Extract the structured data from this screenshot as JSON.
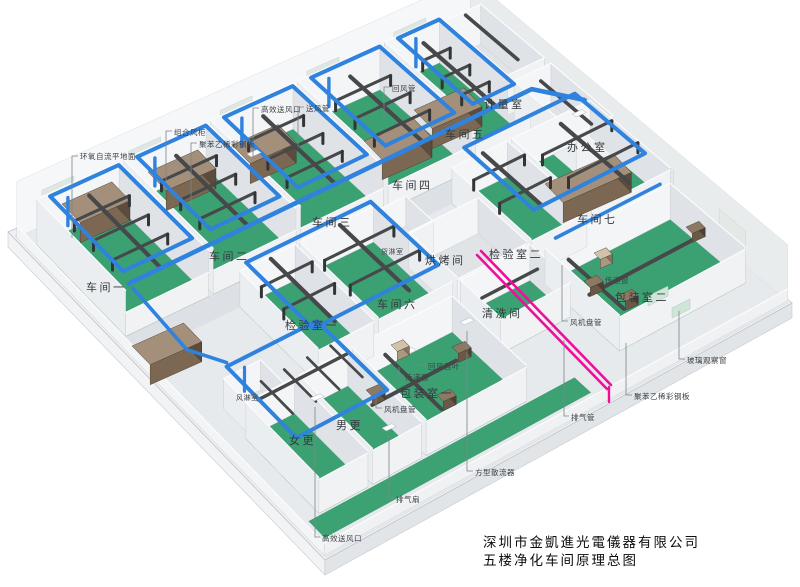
{
  "title_block": {
    "line1": "深圳市金凱進光電儀器有限公司",
    "line2": "五楼净化车间原理总图"
  },
  "rooms": [
    {
      "id": "workshop-1",
      "label": "车间一"
    },
    {
      "id": "workshop-2",
      "label": "车间二"
    },
    {
      "id": "workshop-3",
      "label": "车间三"
    },
    {
      "id": "workshop-4",
      "label": "车间四"
    },
    {
      "id": "workshop-5",
      "label": "车间五"
    },
    {
      "id": "metering-room",
      "label": "计量室"
    },
    {
      "id": "office",
      "label": "办公室"
    },
    {
      "id": "workshop-7",
      "label": "车间七"
    },
    {
      "id": "inspection-room-2",
      "label": "检验室二"
    },
    {
      "id": "baking-room",
      "label": "烘烤间"
    },
    {
      "id": "cargo-shower-room",
      "label": "货淋室"
    },
    {
      "id": "cleaning-room",
      "label": "清洗间"
    },
    {
      "id": "packing-room-2",
      "label": "包装室二"
    },
    {
      "id": "inspection-room-1",
      "label": "检验室一"
    },
    {
      "id": "workshop-6",
      "label": "车间六"
    },
    {
      "id": "packing-room-1",
      "label": "包装室一"
    },
    {
      "id": "women-changing-room",
      "label": "女更"
    },
    {
      "id": "men-changing-room",
      "label": "男更"
    },
    {
      "id": "air-shower-room",
      "label": "风淋室"
    }
  ],
  "callouts": [
    {
      "id": "epoxy-self-leveling-floor",
      "label": "环氧自流平地面"
    },
    {
      "id": "combined-air-handling-unit",
      "label": "组合风柜"
    },
    {
      "id": "polystyrene-steel-panel",
      "label": "聚苯乙稀彩钢板"
    },
    {
      "id": "hepa-supply-outlet",
      "label": "高效送风口"
    },
    {
      "id": "supply-air-duct",
      "label": "送风管"
    },
    {
      "id": "return-air-duct",
      "label": "回风管"
    },
    {
      "id": "return-air-louver",
      "label": "回风百叶"
    },
    {
      "id": "pass-through-window-1",
      "label": "传递窗"
    },
    {
      "id": "fan-coil-unit-1",
      "label": "风机盘管"
    },
    {
      "id": "exhaust-fan",
      "label": "排气扇"
    },
    {
      "id": "hepa-supply-outlet-2",
      "label": "高效送风口"
    },
    {
      "id": "square-diffuser",
      "label": "方型散流器"
    },
    {
      "id": "exhaust-duct",
      "label": "排气管"
    },
    {
      "id": "fan-coil-unit-2",
      "label": "风机盘管"
    },
    {
      "id": "pass-through-window-2",
      "label": "传递窗"
    },
    {
      "id": "glass-observation-window",
      "label": "玻璃观察窗"
    },
    {
      "id": "polystyrene-steel-panel-2",
      "label": "聚苯乙稀彩钢板"
    }
  ],
  "colors": {
    "floor_green": "#3ba172",
    "floor_green_edge": "#2e8a5f",
    "walkway_green": "#3da273",
    "supply_duct_blue": "#2f82dd",
    "branch_duct_gray": "#47484a",
    "nozzle_gray": "#333436",
    "exhaust_duct_pink": "#ee109a",
    "ahu_brown_top": "#a4907a",
    "ahu_brown_front": "#7c6852",
    "ahu_brown_side": "#5c4c3d",
    "slab_gray": "#edeff2",
    "wall_white": "#f3f5f7",
    "leader_line": "#7e848b"
  }
}
